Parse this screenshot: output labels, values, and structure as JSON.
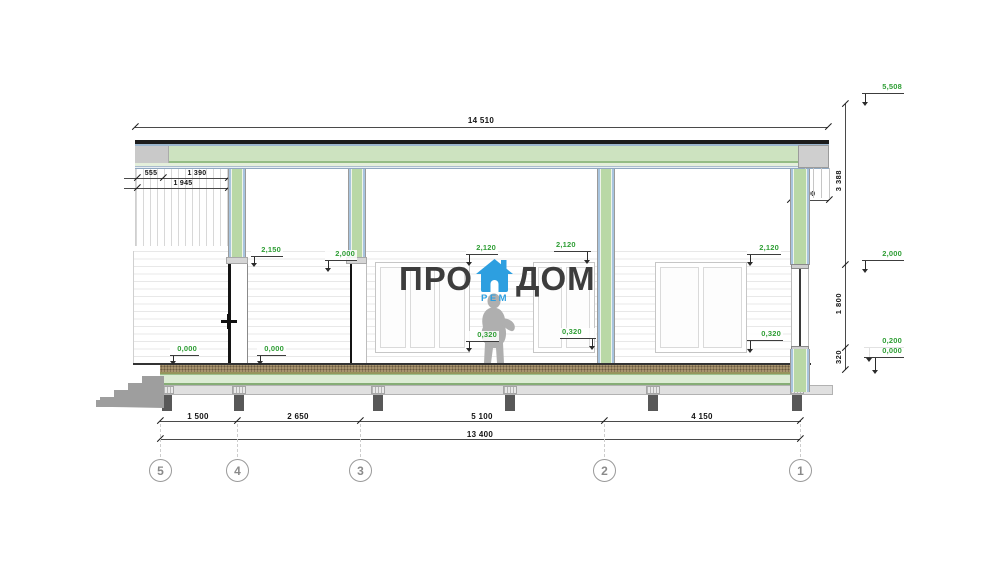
{
  "logo": {
    "word_left": "ПРО",
    "word_right": "ДОМ",
    "word_sub": "РЕМ"
  },
  "dims": {
    "top_total": "14 510",
    "eave_seg1": "555",
    "eave_seg2": "1 390",
    "eave_total": "1 945",
    "fascia_depth": "400",
    "right_upper": "3 388",
    "right_mid": "1 800",
    "right_lower": "320",
    "bot_s1": "1 500",
    "bot_s2": "2 650",
    "bot_s3": "5 100",
    "bot_s4": "4 150",
    "bot_total": "13 400"
  },
  "levels": {
    "ridge": "5,508",
    "wall_top_right": "2,000",
    "deck_top": "0,200",
    "zero_right": "0,000",
    "post_left": "2,150",
    "post_mid": "2,000",
    "win1_top": "2,120",
    "win2_top": "2,120",
    "win3_top": "2,120",
    "win1_sill": "0,320",
    "win2_sill": "0,320",
    "win3_sill": "0,320",
    "floor_a": "0,000",
    "floor_b": "0,000"
  },
  "grid": {
    "g5": "5",
    "g4": "4",
    "g3": "3",
    "g2": "2",
    "g1": "1"
  },
  "colors": {
    "accent_green_label": "#2f9e35",
    "logo_blue": "#2d9fe0",
    "wall_green": "#b9d8a6",
    "deck_green": "#dcecd4"
  }
}
